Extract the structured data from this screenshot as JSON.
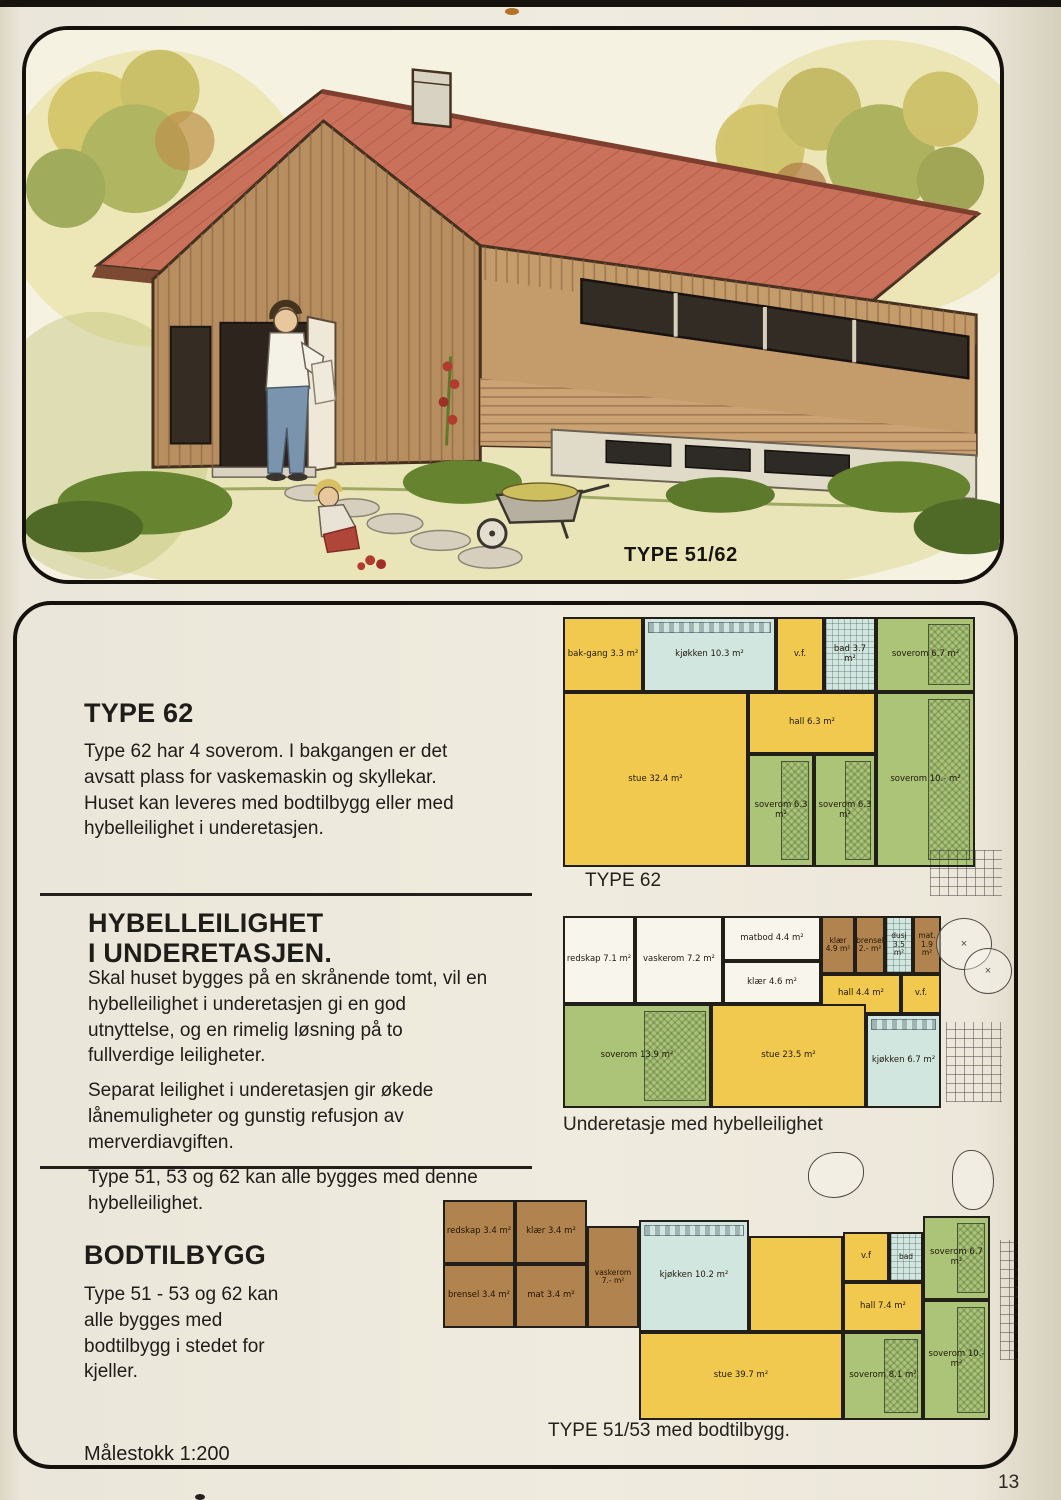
{
  "page": {
    "number": "13",
    "scale_note": "Målestokk 1:200"
  },
  "hero": {
    "caption": "TYPE 51/62"
  },
  "palette": {
    "page_bg": "#ece8db",
    "ink": "#1f1d1a",
    "room_yellow": "#f1c94e",
    "room_green": "#abc477",
    "room_blue": "#d2e6e0",
    "room_brown": "#b0834f",
    "room_white": "#f8f5ec",
    "roof_red": "#c9715a",
    "wood_brown": "#b78e60"
  },
  "sections": {
    "type62": {
      "heading": "TYPE 62",
      "body": "Type 62 har 4 soverom. I bakgangen er det avsatt plass for vaskemaskin og skyllekar. Huset kan leveres med bodtilbygg eller med hybelleilighet i underetasjen."
    },
    "hybel": {
      "heading_line1": "HYBELLEILIGHET",
      "heading_line2": "I UNDERETASJEN.",
      "para1": "Skal huset bygges på en skrånende tomt, vil en hybelleilighet i underetasjen gi en god utnyttelse, og en rimelig løsning på to fullverdige leiligheter.",
      "para2": "Separat leilighet i underetasjen gir økede lånemuligheter og gunstig refusjon av merverdiavgiften.",
      "para3": "Type 51, 53 og 62 kan alle bygges med denne hybelleilighet."
    },
    "bod": {
      "heading": "BODTILBYGG",
      "body": "Type 51 - 53 og 62 kan alle bygges med bodtilbygg i stedet for kjeller."
    }
  },
  "plans": {
    "plan1": {
      "caption": "TYPE 62",
      "rooms": {
        "bakgang": "bak-gang 3.3 m²",
        "kjokken": "kjøkken 10.3 m²",
        "vf": "v.f.",
        "bad": "bad 3.7 m²",
        "soverom_a": "soverom 6.7 m²",
        "stue": "stue 32.4 m²",
        "hall": "hall 6.3 m²",
        "soverom_b": "soverom 6.3 m²",
        "soverom_c": "soverom 6.3 m²",
        "soverom_d": "soverom 10.- m²"
      }
    },
    "plan2": {
      "caption": "Underetasje med hybelleilighet",
      "rooms": {
        "redskap": "redskap 7.1 m²",
        "vaskerom": "vaskerom 7.2 m²",
        "matbod": "matbod 4.4 m²",
        "klaer_a": "klær 4.6 m²",
        "klaer_b": "klær 4.9 m²",
        "brensel": "brensel 2.- m²",
        "dusj": "dusj 3.5 m²",
        "mat": "mat. 1.9 m²",
        "hall": "hall 4.4 m²",
        "vf": "v.f.",
        "soverom": "soverom 13.9 m²",
        "stue": "stue 23.5 m²",
        "kjokken": "kjøkken 6.7 m²"
      }
    },
    "plan3": {
      "caption": "TYPE 51/53 med bodtilbygg.",
      "rooms": {
        "redskap": "redskap 3.4 m²",
        "klaer": "klær 3.4 m²",
        "brensel": "brensel 3.4 m²",
        "mat": "mat 3.4 m²",
        "vaskerom": "vaskerom 7.- m²",
        "kjokken": "kjøkken 10.2 m²",
        "stue": "stue 39.7 m²",
        "vf": "v.f",
        "bad": "bad",
        "hall": "hall 7.4 m²",
        "soverom_a": "soverom 6.7 m²",
        "soverom_b": "soverom 8.1 m²",
        "soverom_c": "soverom 10.- m²"
      }
    }
  }
}
